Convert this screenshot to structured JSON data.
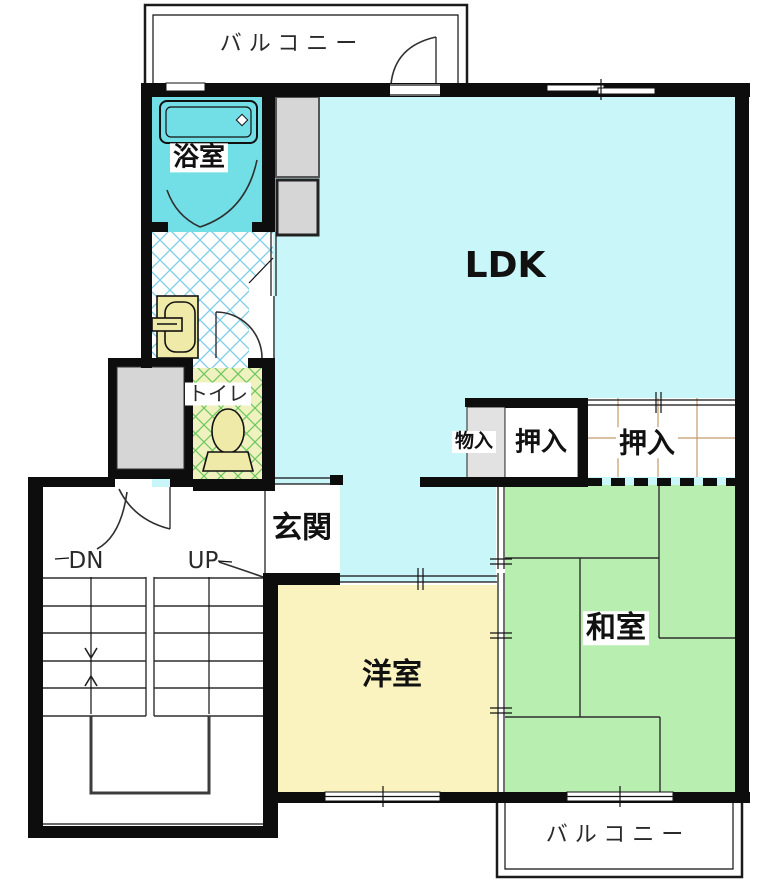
{
  "floorplan": {
    "type": "apartment-floor-plan",
    "rooms": {
      "balcony_top": {
        "label": "バルコニー"
      },
      "bathroom": {
        "label": "浴室"
      },
      "toilet": {
        "label": "トイレ"
      },
      "ldk": {
        "label": "LDK"
      },
      "storage": {
        "label": "物入"
      },
      "closet_left": {
        "label": "押入"
      },
      "closet_right": {
        "label": "押入"
      },
      "entrance": {
        "label": "玄関"
      },
      "stairs": {
        "down": "DN",
        "up": "UP"
      },
      "western_room": {
        "label": "洋室"
      },
      "japanese_room": {
        "label": "和室"
      },
      "balcony_bottom": {
        "label": "バルコニー"
      }
    },
    "colors": {
      "wall": "#0d0d0d",
      "ldk": "#C9F6F8",
      "bath": "#72DEE6",
      "tatami": "#B8EFB0",
      "western": "#FAF3C0",
      "toiletbg": "#EFF2BE",
      "graybox": "#D6D6D6",
      "fixture": "#F0EAA8",
      "grid": "#C89A6E",
      "hatchblue": "#7CCDE6",
      "hatchgreen": "#6CC75F"
    }
  }
}
